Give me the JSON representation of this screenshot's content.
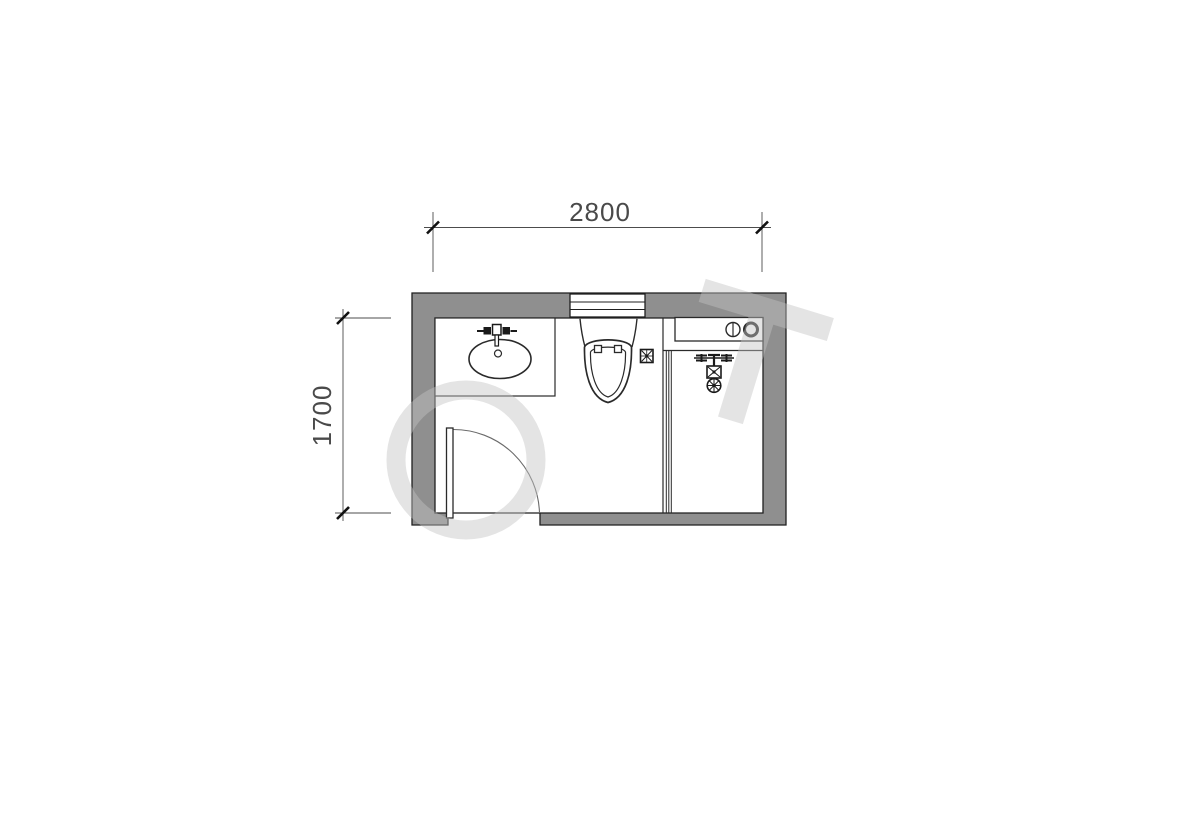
{
  "page": {
    "background_color": "#ffffff"
  },
  "plan": {
    "name": "bathroom-floor-plan",
    "dimensions": {
      "width": {
        "label": "2800"
      },
      "height": {
        "label": "1700"
      }
    },
    "colors": {
      "wall_fill": "#8f8f8f",
      "wall_outline": "#1f1f1f",
      "fixture_line": "#2a2a2a",
      "dimension_line": "#4c4c4c",
      "dimension_text": "#4a4a4a",
      "door_arc": "#6a6a6a",
      "watermark": "#c3c3c3"
    },
    "fixtures": [
      {
        "name": "window",
        "location": "top-wall"
      },
      {
        "name": "sink-counter",
        "location": "top-left"
      },
      {
        "name": "toilet",
        "location": "top-center"
      },
      {
        "name": "floor-drain",
        "location": "beside-toilet"
      },
      {
        "name": "washer-counter",
        "location": "top-right"
      },
      {
        "name": "shower-set",
        "location": "right"
      },
      {
        "name": "glass-partition",
        "location": "center-right"
      },
      {
        "name": "entry-door",
        "location": "bottom-left"
      }
    ]
  }
}
